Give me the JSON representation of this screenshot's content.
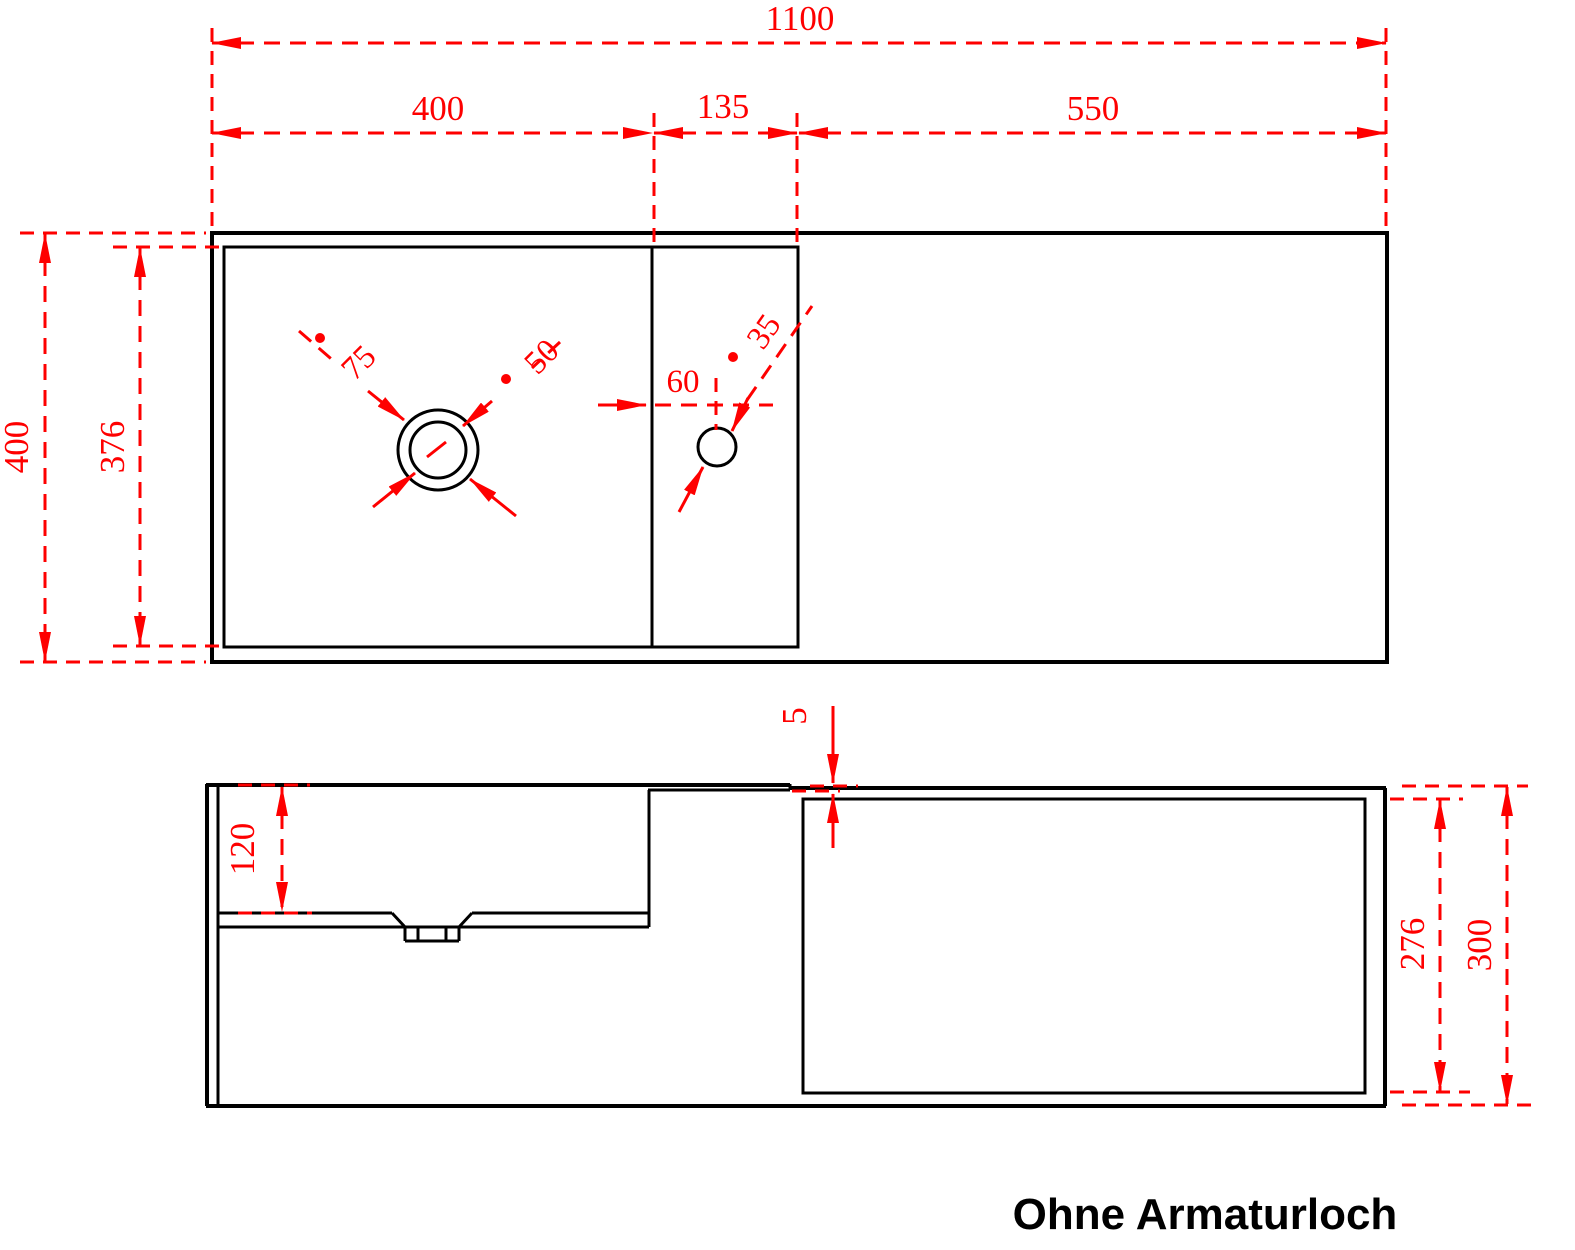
{
  "colors": {
    "dimension_red": "#fe0000",
    "line_black": "#000000",
    "background": "#ffffff"
  },
  "caption": {
    "text": "Ohne Armaturloch"
  },
  "views": {
    "top": {
      "label": "top-view",
      "dimensions": {
        "total_width": "1100",
        "basin_width": "400",
        "deck_width": "135",
        "counter_width": "550",
        "total_depth": "400",
        "inner_depth": "376",
        "drain_outer_diameter": "75",
        "drain_inner_diameter": "50",
        "hole_offset": "60",
        "hole_diameter": "35"
      }
    },
    "side": {
      "label": "side-view",
      "dimensions": {
        "basin_depth": "120",
        "step_height": "5",
        "recess_height": "276",
        "total_height": "300"
      }
    }
  }
}
